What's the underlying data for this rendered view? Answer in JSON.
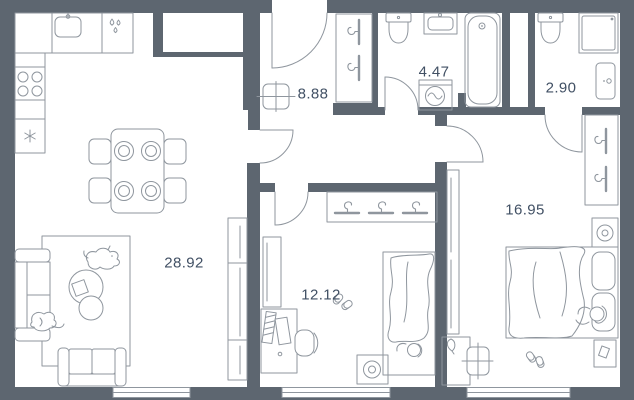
{
  "plan": {
    "colors": {
      "wall": "#5d6670",
      "floor": "#ffffff",
      "line": "#8f969e",
      "label": "#415064"
    },
    "rooms": [
      {
        "name": "living-room-kitchen",
        "area": "28.92"
      },
      {
        "name": "hallway",
        "area": "8.88"
      },
      {
        "name": "bathroom",
        "area": "4.47"
      },
      {
        "name": "shower-wc",
        "area": "2.90"
      },
      {
        "name": "bedroom",
        "area": "16.95"
      },
      {
        "name": "bedroom-2",
        "area": "12.12"
      }
    ]
  }
}
